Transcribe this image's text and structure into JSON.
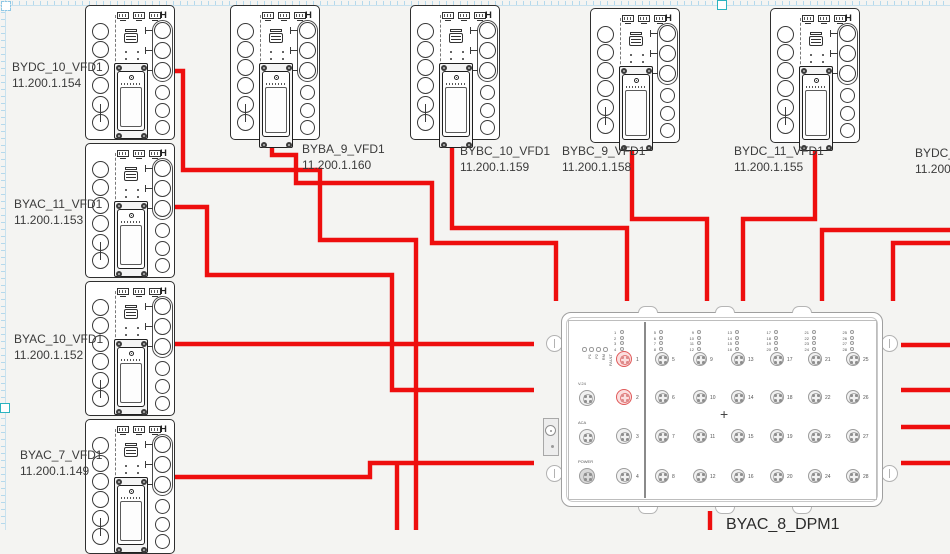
{
  "canvas": {
    "background": "#f4f4f2",
    "ruler_color": "#b5d9ec",
    "handle_color": "#2ab3c0",
    "wire_color": "#ee0e0e"
  },
  "vfd_marker": "H",
  "vfds": [
    {
      "name": "BYDC_10_VFD1",
      "ip": "11.200.1.154"
    },
    {
      "name": "BYAC_11_VFD1",
      "ip": "11.200.1.153"
    },
    {
      "name": "BYAC_10_VFD1",
      "ip": "11.200.1.152"
    },
    {
      "name": "BYAC_7_VFD1",
      "ip": "11.200.1.149"
    },
    {
      "name": "BYBA_9_VFD1",
      "ip": "11.200.1.160"
    },
    {
      "name": "BYBC_10_VFD1",
      "ip": "11.200.1.159"
    },
    {
      "name": "BYBC_9_VFD1",
      "ip": "11.200.1.158"
    },
    {
      "name": "BYDC_11_VFD1",
      "ip": "11.200.1.155"
    },
    {
      "name": "BYDC_12",
      "ip": "11.200.1"
    }
  ],
  "dpm": {
    "name": "BYAC_8_DPM1",
    "status_leds": [
      "P1",
      "P2",
      "RM",
      "FAULT"
    ],
    "connectors": [
      "V.24",
      "ACA",
      "POWER"
    ],
    "left_ports": [
      "1",
      "2",
      "3",
      "4"
    ],
    "highlighted_ports": [
      "1",
      "2"
    ],
    "port_columns": [
      [
        "5",
        "6",
        "7",
        "8"
      ],
      [
        "9",
        "10",
        "11",
        "12"
      ],
      [
        "13",
        "14",
        "15",
        "16"
      ],
      [
        "17",
        "18",
        "19",
        "20"
      ],
      [
        "21",
        "22",
        "23",
        "24"
      ],
      [
        "25",
        "26",
        "27",
        "28"
      ]
    ],
    "center_marker": "+",
    "highlight_color": "#e05a5a"
  }
}
